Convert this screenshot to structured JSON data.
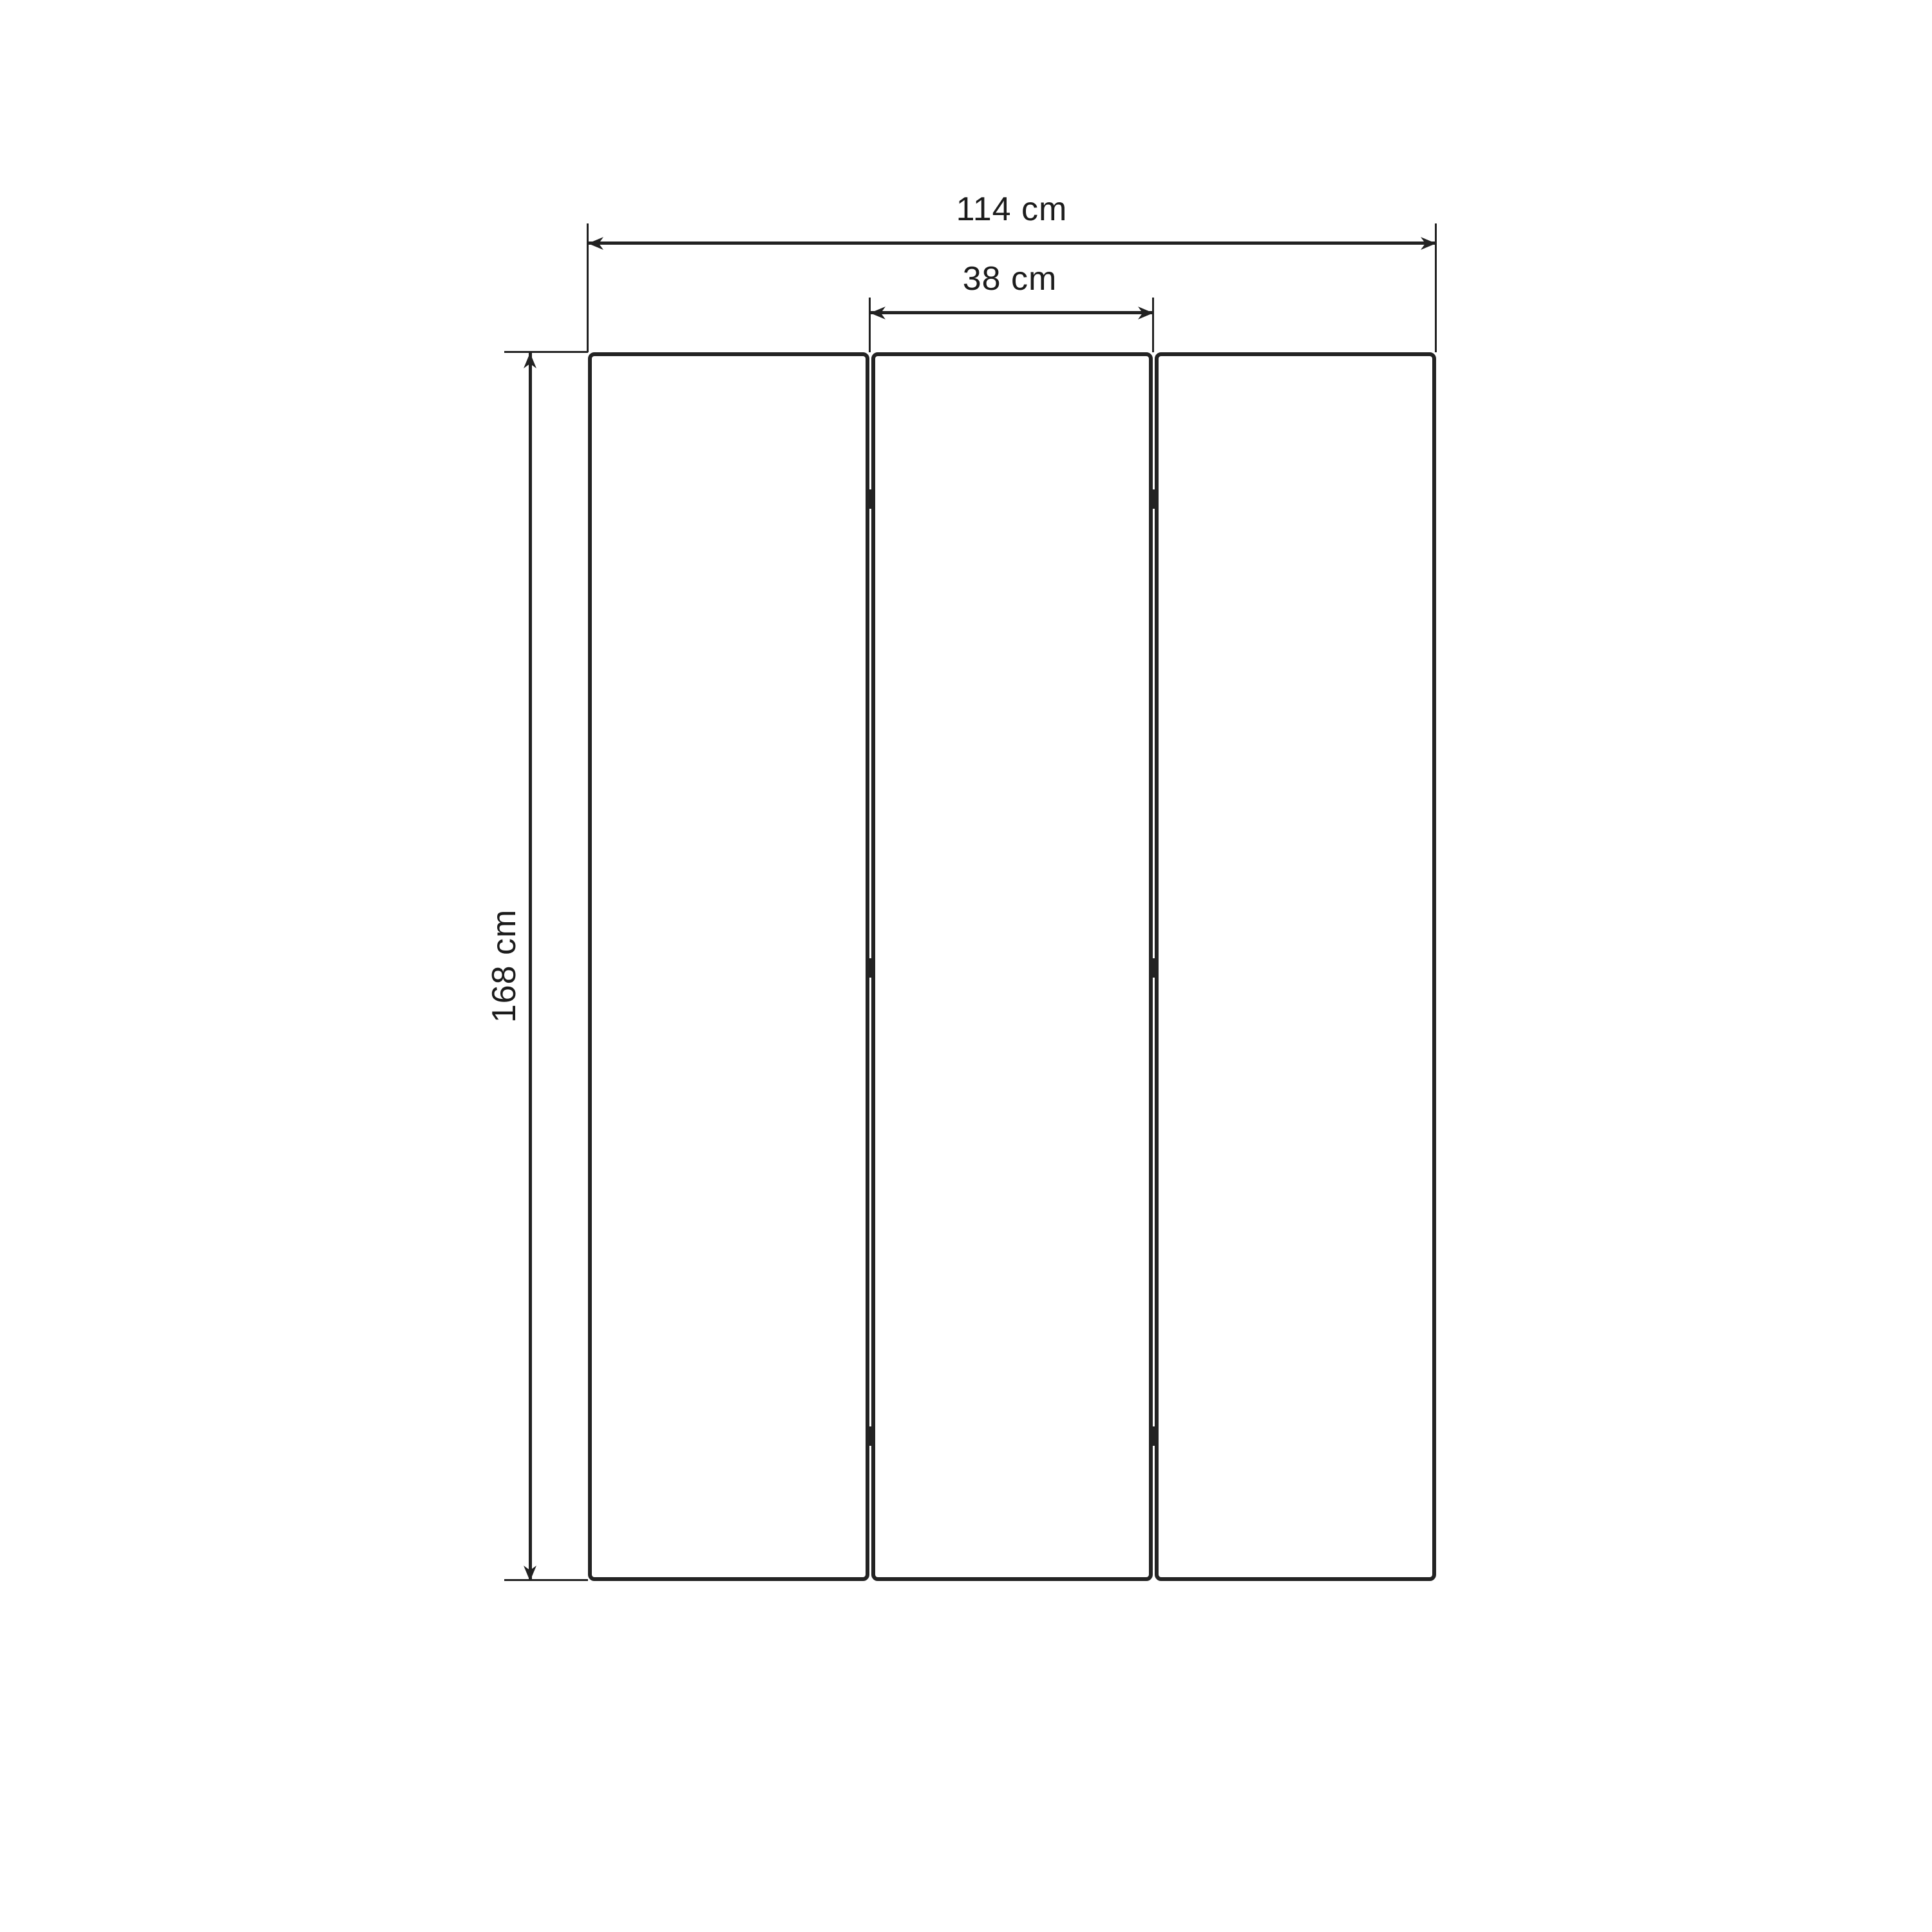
{
  "diagram": {
    "background_color": "#ffffff",
    "line_color": "#222222",
    "text_color": "#1c1c1c",
    "dimensions": {
      "total_width": {
        "label": "114 cm"
      },
      "panel_width": {
        "label": "38 cm"
      },
      "height": {
        "label": "168 cm"
      }
    },
    "panels": [
      {
        "name": "left"
      },
      {
        "name": "middle"
      },
      {
        "name": "right"
      }
    ],
    "hinge_marker_count": 6
  }
}
